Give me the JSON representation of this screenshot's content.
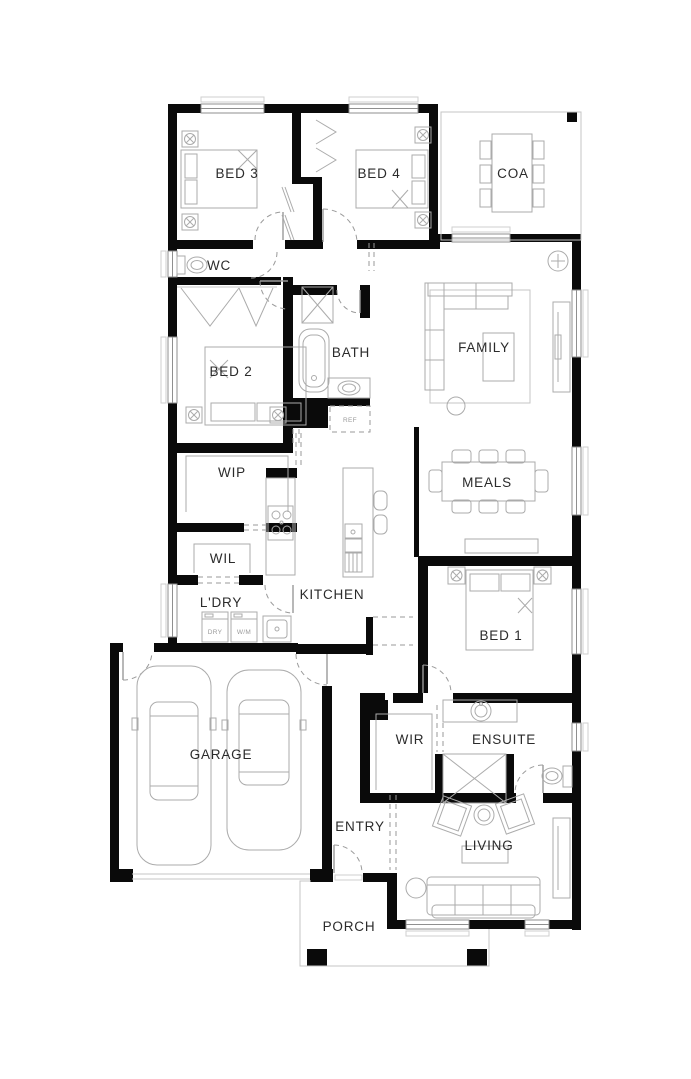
{
  "document": {
    "type": "architectural-floor-plan"
  },
  "rooms": {
    "bed3": {
      "label": "BED 3"
    },
    "bed4": {
      "label": "BED 4"
    },
    "coa": {
      "label": "COA"
    },
    "wc": {
      "label": "WC"
    },
    "bath": {
      "label": "BATH"
    },
    "family": {
      "label": "FAMILY"
    },
    "bed2": {
      "label": "BED 2"
    },
    "wip": {
      "label": "WIP"
    },
    "meals": {
      "label": "MEALS"
    },
    "wil": {
      "label": "WIL"
    },
    "kitchen": {
      "label": "KITCHEN"
    },
    "ldry": {
      "label": "L'DRY"
    },
    "bed1": {
      "label": "BED 1"
    },
    "garage": {
      "label": "GARAGE"
    },
    "wir": {
      "label": "WIR"
    },
    "ensuite": {
      "label": "ENSUITE"
    },
    "entry": {
      "label": "ENTRY"
    },
    "living": {
      "label": "LIVING"
    },
    "porch": {
      "label": "PORCH"
    }
  },
  "appliances": {
    "dryer": {
      "label": "DRY"
    },
    "washer": {
      "label": "W/M"
    },
    "fridge": {
      "label": "REF"
    }
  },
  "colors": {
    "wall": "#0a0a0a",
    "furniture_line": "#ababab",
    "label_text": "#2b2b2b",
    "background": "#ffffff"
  }
}
